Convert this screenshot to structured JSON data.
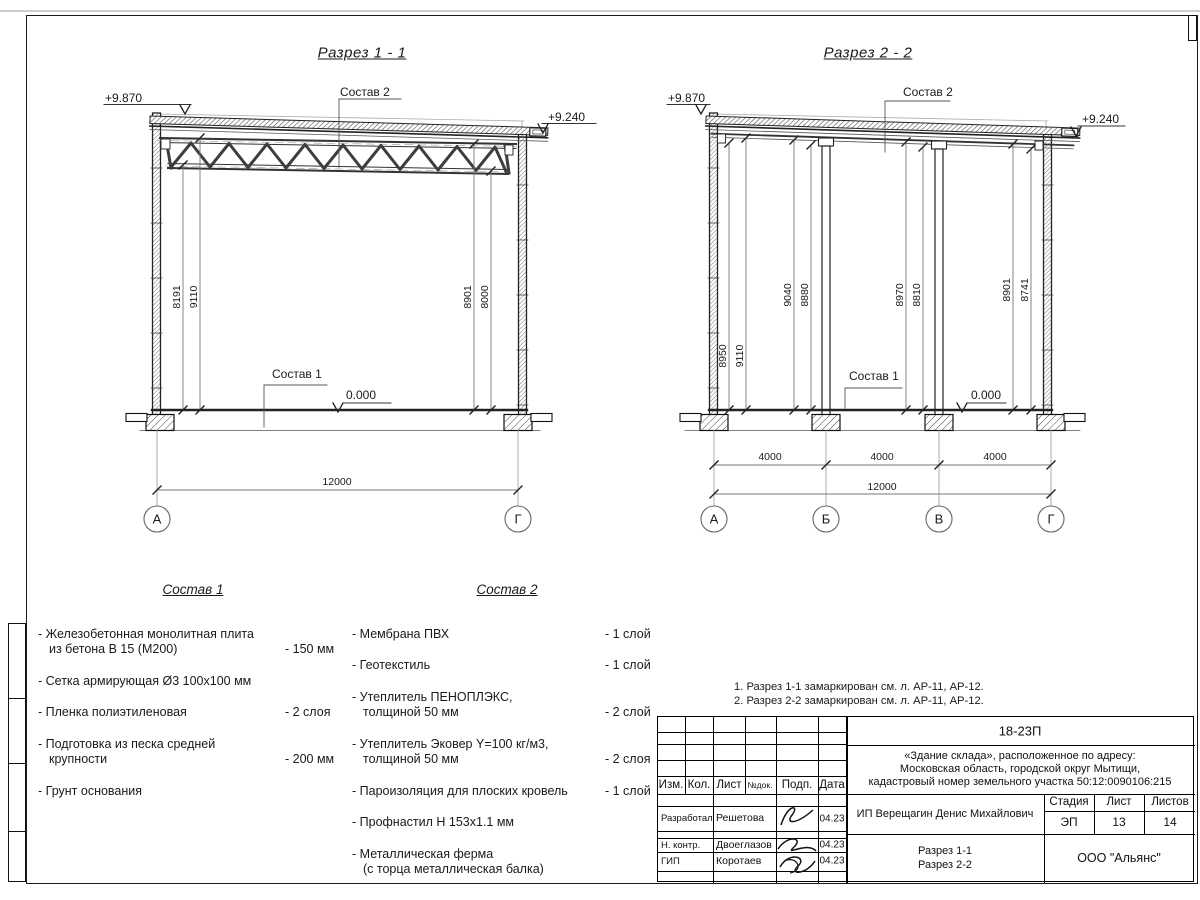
{
  "section1": {
    "title": "Разрез 1 - 1",
    "elev_left": "+9.870",
    "elev_right": "+9.240",
    "elev_floor": "0.000",
    "label_roof": "Состав 2",
    "label_floor": "Состав 1",
    "dim_8191": "8191",
    "dim_9110": "9110",
    "dim_8901": "8901",
    "dim_8000": "8000",
    "dim_total": "12000",
    "axis_a": "А",
    "axis_g": "Г"
  },
  "section2": {
    "title": "Разрез 2 - 2",
    "elev_left": "+9.870",
    "elev_right": "+9.240",
    "elev_floor": "0.000",
    "label_roof": "Состав 2",
    "label_floor": "Состав 1",
    "dim_8950": "8950",
    "dim_9110": "9110",
    "dim_9040": "9040",
    "dim_8880": "8880",
    "dim_8970": "8970",
    "dim_8810": "8810",
    "dim_8901": "8901",
    "dim_8741": "8741",
    "span_ab": "4000",
    "span_bv": "4000",
    "span_vg": "4000",
    "dim_total": "12000",
    "axis_a": "А",
    "axis_b": "Б",
    "axis_v": "В",
    "axis_g": "Г"
  },
  "sostav1": {
    "title": "Состав 1",
    "items": [
      {
        "name": "- Железобетонная  монолитная плита\nиз бетона В 15 (М200)",
        "value": "- 150 мм"
      },
      {
        "name": "- Сетка армирующая Ø3 100х100 мм",
        "value": ""
      },
      {
        "name": "- Пленка полиэтиленовая",
        "value": "-  2 слоя"
      },
      {
        "name": "- Подготовка из песка средней\nкрупности",
        "value": "- 200 мм"
      },
      {
        "name": "- Грунт основания",
        "value": ""
      }
    ]
  },
  "sostav2": {
    "title": "Состав 2",
    "items": [
      {
        "name": "- Мембрана ПВХ",
        "value": "- 1 слой"
      },
      {
        "name": "- Геотекстиль",
        "value": "- 1 слой"
      },
      {
        "name": "- Утеплитель ПЕНОПЛЭКС,\nтолщиной 50 мм",
        "value": "- 2 слой"
      },
      {
        "name": "- Утеплитель Эковер Y=100 кг/м3,\nтолщиной 50 мм",
        "value": "- 2 слоя"
      },
      {
        "name": "- Пароизоляция для плоских кровель",
        "value": "- 1 слой"
      },
      {
        "name": "- Профнастил Н 153х1.1 мм",
        "value": ""
      },
      {
        "name": "- Металлическая ферма\n(с торца металлическая балка)",
        "value": ""
      }
    ]
  },
  "notes": {
    "line1": "1. Разрез 1-1 замаркирован см. л. АР-11, АР-12.",
    "line2": "2. Разрез 2-2 замаркирован см. л. АР-11, АР-12."
  },
  "titleblock": {
    "doc_number": "18-23П",
    "object_line1": "«Здание склада», расположенное по адресу:",
    "object_line2": "Московская область, городской округ Мытищи,",
    "object_line3": "кадастровый номер земельного участка 50:12:0090106:215",
    "client": "ИП Верещагин Денис Михайлович",
    "col_izm": "Изм.",
    "col_kol": "Кол.",
    "col_list": "Лист",
    "col_ndok": "№док.",
    "col_podp": "Подп.",
    "col_data": "Дата",
    "row_dev_role": "Разработал",
    "row_dev_name": "Решетова",
    "row_dev_date": "04.23",
    "row_ncontr_role": "Н. контр.",
    "row_ncontr_name": "Двоеглазов",
    "row_ncontr_date": "04.23",
    "row_gip_role": "ГИП",
    "row_gip_name": "Коротаев",
    "row_gip_date": "04.23",
    "stage_label": "Стадия",
    "sheet_label": "Лист",
    "sheets_label": "Листов",
    "stage_value": "ЭП",
    "sheet_value": "13",
    "sheets_value": "14",
    "sheet_name_line1": "Разрез 1-1",
    "sheet_name_line2": "Разрез 2-2",
    "company": "ООО \"Альянс\""
  }
}
